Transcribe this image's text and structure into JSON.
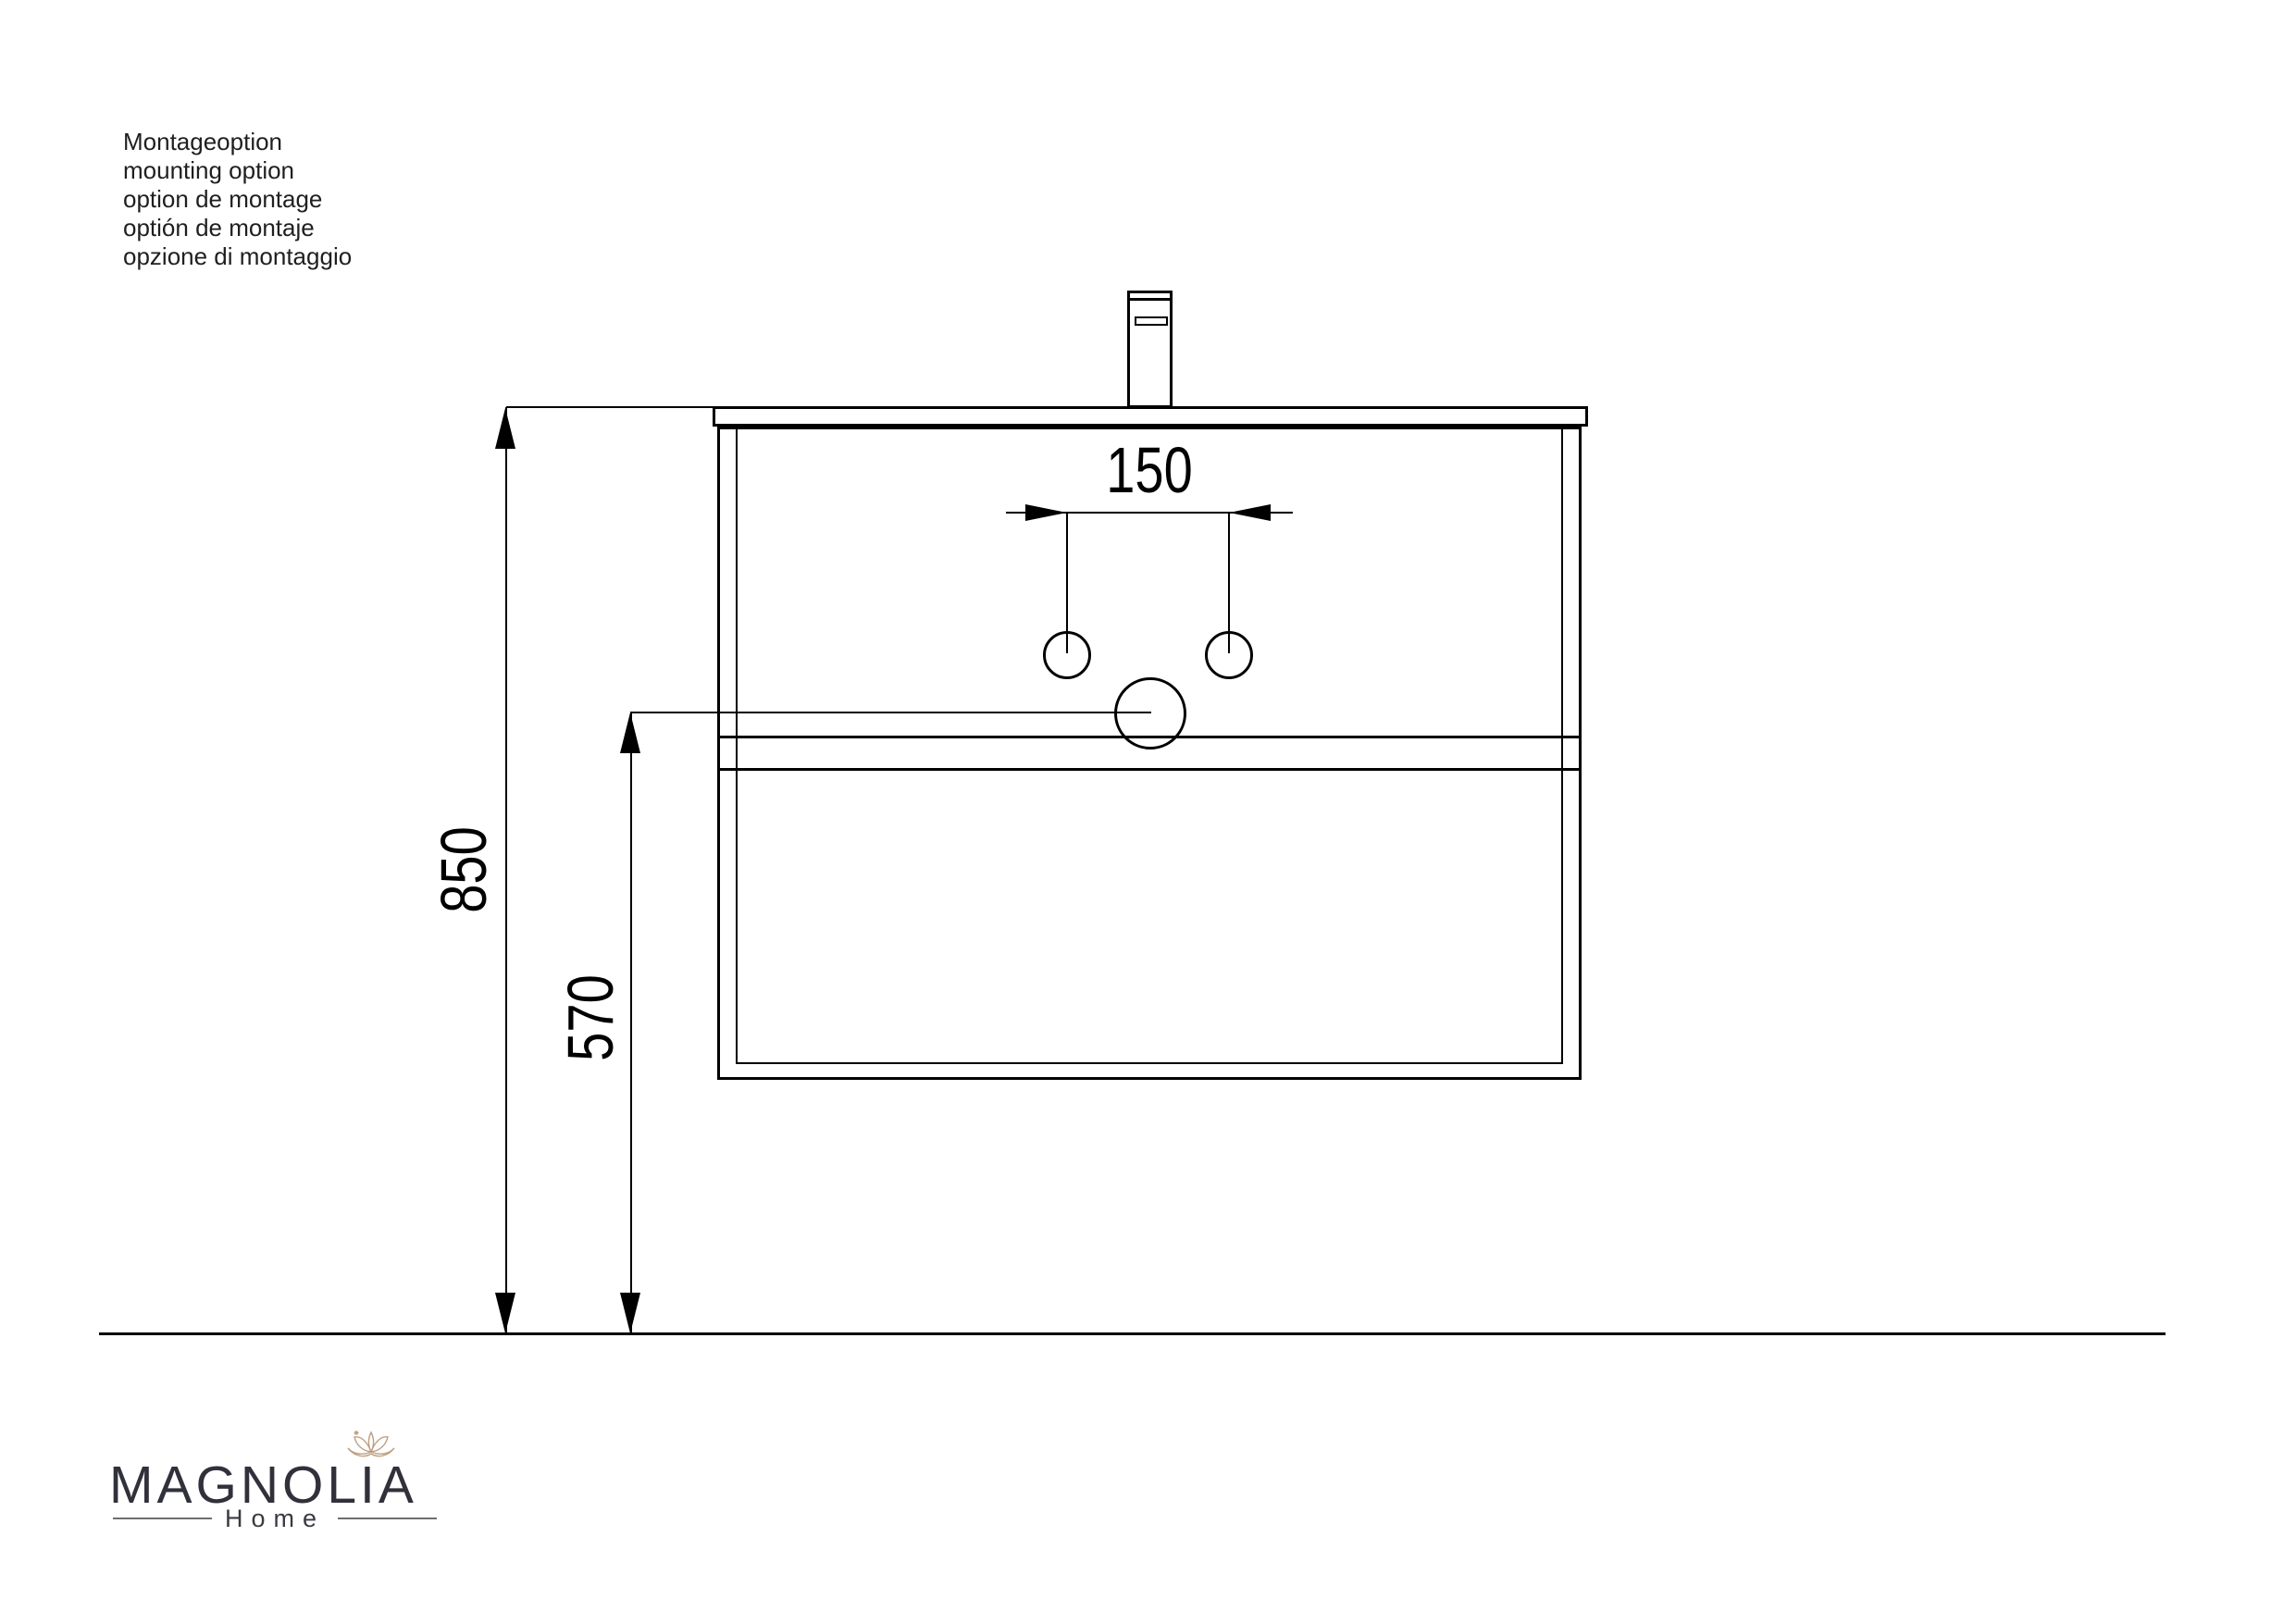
{
  "notes": {
    "lines": [
      "Montageoption",
      "mounting option",
      "option de montage",
      "optión de montaje",
      "opzione di montaggio"
    ]
  },
  "dimensions": {
    "faucet_hole_spacing": "150",
    "mounting_height": "850",
    "drain_height": "570"
  },
  "logo": {
    "brand": "MAGNOLIA",
    "subtitle": "Home"
  },
  "icons": {
    "flower": "magnolia-flower-icon"
  },
  "colors": {
    "background": "#ffffff",
    "line": "#000000",
    "notes_text": "#1f1f1f",
    "dimension_text": "#000000",
    "logo_text": "#31313b",
    "logo_rule": "#6e6e6e",
    "flower": "#bf9e80"
  }
}
